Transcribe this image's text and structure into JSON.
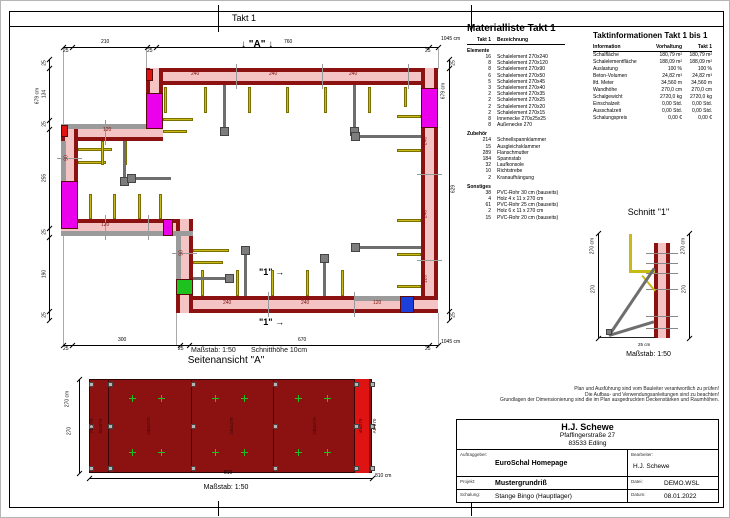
{
  "colors": {
    "wall_fill": "#f4c3c3",
    "wall_edge": "#8c1111",
    "magenta": "#ea00ea",
    "green": "#1ec21e",
    "blue": "#1b3fd8",
    "red": "#e01313",
    "yellow": "#c9bb16",
    "elev_fill": "#8c1212",
    "elev_strip": "#e01313",
    "brace": "#6e6e6e",
    "joint": "#9a9a9a",
    "ext": "#aaaaaa",
    "tie": "#888888"
  },
  "sheet": {
    "band_title": "Takt 1"
  },
  "plan": {
    "marker_a": "\"A\"",
    "marker_arrow_down": "↓",
    "marker_1": "\"1\"",
    "marker_arrow_right": "→",
    "scale_label": "Maßstab: 1:50",
    "cut_height_label": "Schnitthöhe 10cm",
    "dim_top": [
      {
        "t": "25",
        "x": 62,
        "y": 48
      },
      {
        "t": "210",
        "x": 100,
        "y": 39
      },
      {
        "t": "25",
        "x": 146,
        "y": 48
      },
      {
        "t": "760",
        "x": 283,
        "y": 39
      },
      {
        "t": "25",
        "x": 424,
        "y": 48
      },
      {
        "t": "1045 cm",
        "x": 440,
        "y": 36
      }
    ],
    "dim_bottom": [
      {
        "t": "25",
        "x": 62,
        "y": 346
      },
      {
        "t": "300",
        "x": 117,
        "y": 337
      },
      {
        "t": "25",
        "x": 177,
        "y": 346
      },
      {
        "t": "670",
        "x": 297,
        "y": 337
      },
      {
        "t": "25",
        "x": 424,
        "y": 346
      },
      {
        "t": "1045 cm",
        "x": 440,
        "y": 339
      }
    ],
    "dim_left": [
      {
        "t": "25",
        "y": 62
      },
      {
        "t": "134",
        "y": 93
      },
      {
        "t": "25",
        "y": 123
      },
      {
        "t": "255",
        "y": 177
      },
      {
        "t": "25",
        "y": 231
      },
      {
        "t": "190",
        "y": 273
      },
      {
        "t": "25",
        "y": 314
      }
    ],
    "dim_left_total": "679 cm",
    "dim_right": [
      {
        "t": "25",
        "y": 62
      },
      {
        "t": "629",
        "y": 188
      },
      {
        "t": "25",
        "y": 314
      }
    ],
    "dim_right_total": "679 cm",
    "wall_labels": [
      {
        "t": "240",
        "x": 190,
        "y": 71
      },
      {
        "t": "240",
        "x": 268,
        "y": 71
      },
      {
        "t": "240",
        "x": 348,
        "y": 71
      },
      {
        "t": "240",
        "x": 425,
        "y": 140,
        "r": 1
      },
      {
        "t": "240",
        "x": 425,
        "y": 213,
        "r": 1
      },
      {
        "t": "120",
        "x": 425,
        "y": 278,
        "r": 1
      },
      {
        "t": "240",
        "x": 222,
        "y": 300
      },
      {
        "t": "240",
        "x": 300,
        "y": 300
      },
      {
        "t": "120",
        "x": 372,
        "y": 300
      },
      {
        "t": "120",
        "x": 102,
        "y": 127
      },
      {
        "t": "90",
        "x": 66,
        "y": 157,
        "r": 1
      },
      {
        "t": "120",
        "x": 100,
        "y": 222
      },
      {
        "t": "90",
        "x": 181,
        "y": 252,
        "r": 1
      }
    ]
  },
  "materialliste": {
    "title": "Materialliste  Takt 1",
    "col_qty": "Takt 1",
    "col_name": "Bezeichnung",
    "sections": [
      {
        "name": "Elemente",
        "rows": [
          [
            "16",
            "Schalelement 270x240"
          ],
          [
            "8",
            "Schalelement 270x120"
          ],
          [
            "8",
            "Schalelement 270x90"
          ],
          [
            "6",
            "Schalelement 270x50"
          ],
          [
            "5",
            "Schalelement 270x45"
          ],
          [
            "3",
            "Schalelement 270x40"
          ],
          [
            "2",
            "Schalelement 270x35"
          ],
          [
            "2",
            "Schalelement 270x25"
          ],
          [
            "2",
            "Schalelement 270x20"
          ],
          [
            "2",
            "Schalelement 270x15"
          ],
          [
            "8",
            "Innenecke 270x25x25"
          ],
          [
            "8",
            "Außenecke 270"
          ]
        ]
      },
      {
        "name": "Zubehör",
        "rows": [
          [
            "214",
            "Schnellspannklammer"
          ],
          [
            "15",
            "Ausgleichsklammer"
          ],
          [
            "289",
            "Flanschmutter"
          ],
          [
            "184",
            "Spannstab"
          ],
          [
            "32",
            "Laufkonsole"
          ],
          [
            "10",
            "Richtstrebe"
          ],
          [
            "2",
            "Kranaufhängung"
          ]
        ]
      },
      {
        "name": "Sonstiges",
        "rows": [
          [
            "38",
            "PVC-Rohr 30 cm (bauseits)"
          ],
          [
            "4",
            "Holz 4 x 11 x 270 cm"
          ],
          [
            "61",
            "PVC-Rohr 25 cm (bauseits)"
          ],
          [
            "2",
            "Holz 6 x 11 x 270 cm"
          ],
          [
            "15",
            "PVC-Rohr 20 cm (bauseits)"
          ]
        ]
      }
    ]
  },
  "taktinfo": {
    "title": "Taktinformationen  Takt 1 bis 1",
    "headers": [
      "Information",
      "Vorhaltung",
      "Takt 1"
    ],
    "rows": [
      [
        "Schalfläche",
        "180,79 m²",
        "180,79 m²"
      ],
      [
        "Schalelementfläche",
        "188,09 m²",
        "188,09 m²"
      ],
      [
        "Auslastung",
        "100 %",
        "100 %"
      ],
      [
        "Beton-Volumen",
        "24,82 m³",
        "24,82 m³"
      ],
      [
        "lfd. Meter",
        "34,560 m",
        "34,560 m"
      ],
      [
        "Wandhöhe",
        "270,0 cm",
        "270,0 cm"
      ],
      [
        "Schalgewicht",
        "2720,0 kg",
        "2720,0 kg"
      ],
      [
        "Einschalzeit",
        "0,00 Std.",
        "0,00 Std."
      ],
      [
        "Ausschalzeit",
        "0,00 Std.",
        "0,00 Std."
      ],
      [
        "Schalungspreis",
        "0,00 €",
        "0,00 €"
      ]
    ]
  },
  "schnitt": {
    "title": "Schnitt \"1\"",
    "dim_left_total": "270 cm",
    "dim_left": "270",
    "dim_right_total": "270 cm",
    "dim_right": "270",
    "bottom_label": "25 cm",
    "scale_label": "Maßstab: 1:50"
  },
  "seitenansicht": {
    "title": "Seitenansicht \"A\"",
    "dim_left_total": "270 cm",
    "dim_left": "270",
    "dim_bottom": "810",
    "dim_bottom_total": "810 cm",
    "scale_label": "Maßstab: 1:50",
    "element_labels": [
      "AE 270",
      "50x270",
      "240x270",
      "240x270",
      "240x270",
      "40x270",
      "AE 270"
    ]
  },
  "notes": {
    "lines": [
      "Plan und Ausführung sind vom Bauleiter verantwortlich zu prüfen!",
      "Die Aufbau- und Verwendungsanleitungen sind zu beachten!",
      "Grundlagen der Dimensionierung sind die im Plan ausgedruckten Deckenstärken und Raumhöhen."
    ]
  },
  "titleblock": {
    "company": "H.J. Schewe",
    "street": "Pfaffingerstraße 27",
    "city": "83533 Edling",
    "auftraggeber_label": "Auftraggeber:",
    "auftraggeber": "EuroSchal Homepage",
    "bearbeiter_label": "Bearbeiter:",
    "bearbeiter": "H.J. Schewe",
    "projekt_label": "Projekt:",
    "projekt": "Mustergrundriß",
    "datei_label": "Datei:",
    "datei": "DEMO.WSL",
    "schalung_label": "Schalung:",
    "schalung": "Stange Bingo (Hauptlager)",
    "datum_label": "Datum:",
    "datum": "08.01.2022"
  }
}
